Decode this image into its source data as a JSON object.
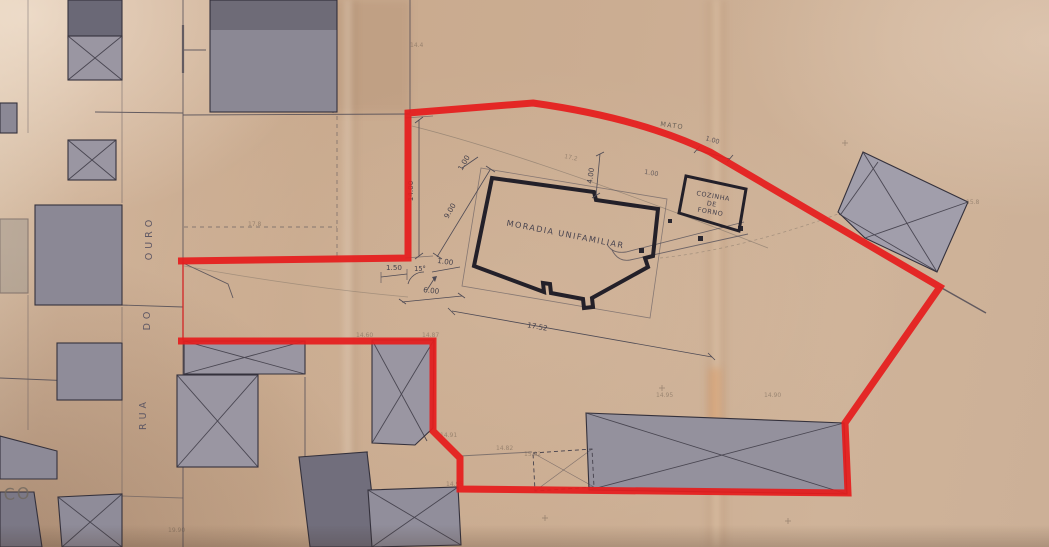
{
  "street": {
    "word1": "RUA",
    "word2": "DO",
    "word3": "OURO"
  },
  "labels": {
    "main_building": "MORADIA UNIFAMILIAR",
    "annex_line1": "COZINHA",
    "annex_line2": "DE",
    "annex_line3": "FORNO",
    "terrain": "MATO",
    "handwritten_corner": "CO"
  },
  "dims": {
    "d14": "14.00",
    "d9": "9.00",
    "d4": "4.00",
    "d6": "6.00",
    "d1752": "17.52",
    "d150": "1.50",
    "dangle": "15°",
    "d1a": "1.00",
    "d1b": "1.00",
    "d1c": "1.00",
    "d1d": "1.00"
  },
  "spots": {
    "s1": "14.4",
    "s2": "17.2",
    "s3": "14.60",
    "s4": "14.87",
    "s5": "14.91",
    "s6": "14.82",
    "s7": "15.02",
    "s8": "14.95",
    "s9": "14.95",
    "s10": "14.90",
    "s11": "15.8",
    "s12": "19.90",
    "s13": "17.8"
  },
  "colors": {
    "paper": "#cbae93",
    "boundary_red": "#e51d1d",
    "building_fill": "#9a96a2",
    "building_dark": "#6f6c7a",
    "ink": "#35323c"
  }
}
